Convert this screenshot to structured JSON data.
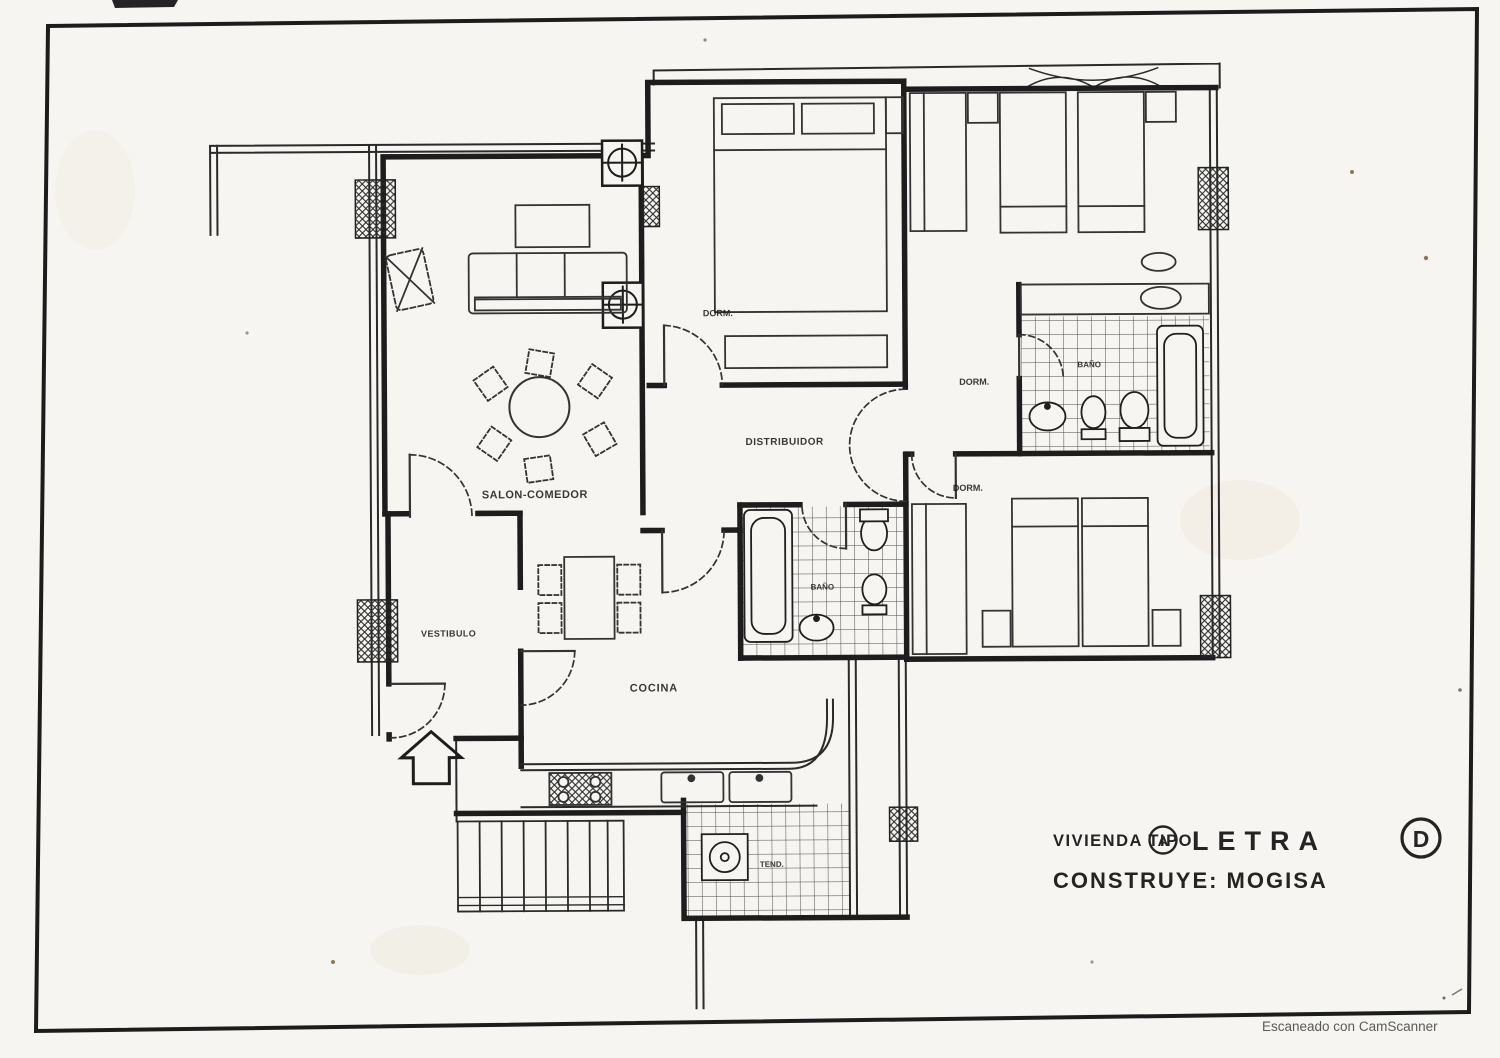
{
  "document": {
    "type_label": "VIVIENDA TIPO",
    "type_circled": "A",
    "letter_label": "LETRA",
    "letter_circled": "D",
    "builder_line": "CONSTRUYE: MOGISA",
    "scanner_watermark": "Escaneado con CamScanner"
  },
  "rooms": {
    "salon_comedor": "SALON-COMEDOR",
    "cocina": "COCINA",
    "vestibulo": "VESTIBULO",
    "distribuidor": "DISTRIBUIDOR",
    "dormitorio_1": "DORM.",
    "dormitorio_2": "DORM.",
    "dormitorio_3": "DORM.",
    "bano_1": "BAÑO",
    "bano_2": "BAÑO",
    "tendedero": "TEND."
  },
  "colors": {
    "ink": "#1d1d1d",
    "paper": "#f6f5f1",
    "watermark": "#5a5a5a"
  }
}
